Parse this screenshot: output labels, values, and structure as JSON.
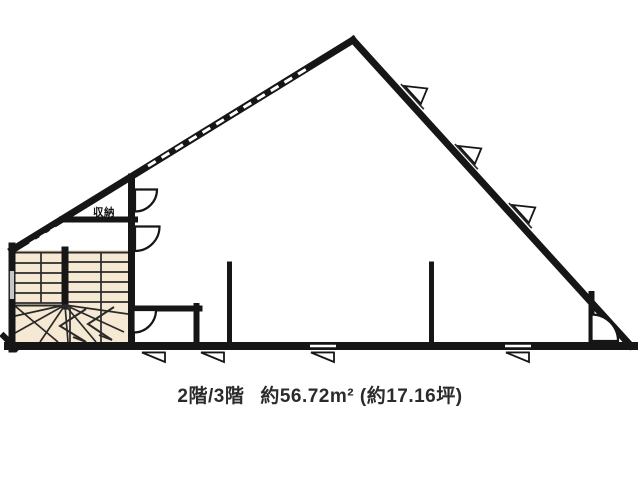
{
  "plan": {
    "closet_label": "収納",
    "colors": {
      "wall": "#161616",
      "line": "#2a2a2a",
      "stair_fill": "#f6e9d3",
      "background": "#ffffff"
    }
  },
  "caption": {
    "floor_label": "2階/3階",
    "area_label": "約56.72m² (約17.16坪)"
  }
}
